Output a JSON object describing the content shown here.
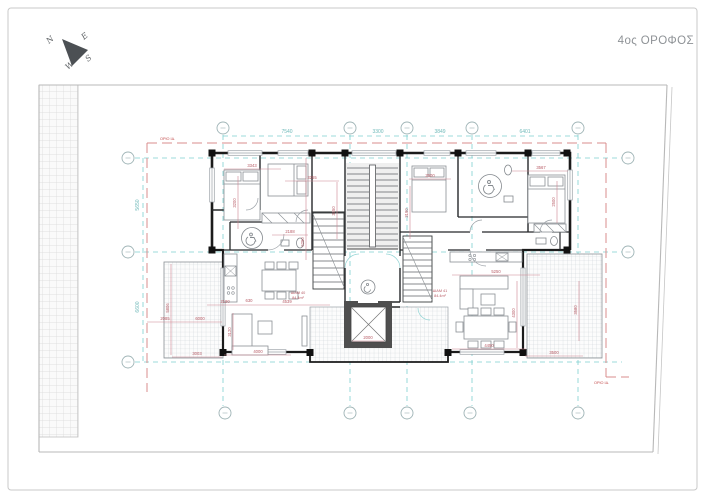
{
  "title": "4ος ΟΡΟΦΟΣ",
  "compass": {
    "n": "N",
    "e": "E",
    "s": "S",
    "w": "W"
  },
  "boundary": {
    "top": "ΟΡΙΟ ΙΔ.",
    "bottom": "ΟΡΙΟ ΙΔ."
  },
  "apartments": [
    {
      "label": "ΔΙΑΜ 40",
      "area": "84.4m²"
    },
    {
      "label": "ΔΙΑΜ 41",
      "area": "84.4m²"
    }
  ],
  "colors": {
    "grid": "#7ecfcf",
    "dimension": "#b85c66",
    "boundary": "#d98c8c",
    "wall": "#1b1b1b"
  },
  "dims": {
    "t7540": "7540",
    "t3300": "3300",
    "t3849": "3849",
    "t6401": "6401",
    "l5650": "5650",
    "l6600": "6600",
    "d3343": "3343",
    "d3255": "3255",
    "d3200": "3200",
    "d3450": "3450",
    "d2500a": "2500",
    "d3567": "3567",
    "d2500b": "2500",
    "d3190": "3190",
    "d2188": "2188",
    "d6250": "6250",
    "d2190": "2190",
    "d630": "630",
    "d4539": "4539",
    "d4000": "4000",
    "d3120": "3120",
    "d2085": "2085",
    "d6000": "6000",
    "d3003": "3003",
    "d5806": "5806",
    "d5250": "5250",
    "d4450": "4450",
    "d4300": "4300",
    "d3580": "3580",
    "d3500": "3500",
    "d2000": "2000"
  }
}
